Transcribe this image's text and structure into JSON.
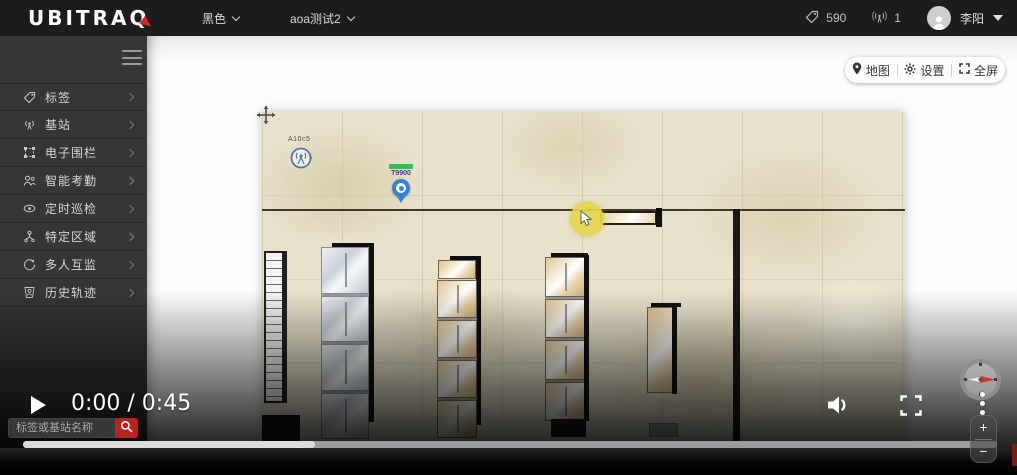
{
  "header": {
    "logo_text": "UBITRAQ",
    "theme_dropdown": "黑色",
    "project_dropdown": "aoa测试2",
    "tag_count": "590",
    "station_count": "1",
    "user_name": "李阳"
  },
  "sidebar": {
    "items": [
      {
        "label": "标签"
      },
      {
        "label": "基站"
      },
      {
        "label": "电子围栏"
      },
      {
        "label": "智能考勤"
      },
      {
        "label": "定时巡检"
      },
      {
        "label": "特定区域"
      },
      {
        "label": "多人互监"
      },
      {
        "label": "历史轨迹"
      }
    ]
  },
  "map_toolbar": {
    "map_label": "地图",
    "settings_label": "设置",
    "fullscreen_label": "全屏"
  },
  "map": {
    "station_marker": {
      "id": "A10c5"
    },
    "tag_marker": {
      "id": "T9900"
    }
  },
  "player": {
    "time_display": "0:00 / 0:45"
  },
  "search": {
    "placeholder": "标签或基站名称"
  },
  "zoom_control": {
    "plus_label": "+",
    "minus_label": "−"
  },
  "colors": {
    "brand_red": "#d8241f",
    "search_button_red": "#b5251d",
    "marker_blue": "#2f86d6",
    "battery_green": "#2fbf4f",
    "highlight_yellow": "#e7d44b",
    "floor_beige": "#e9e2cb"
  }
}
